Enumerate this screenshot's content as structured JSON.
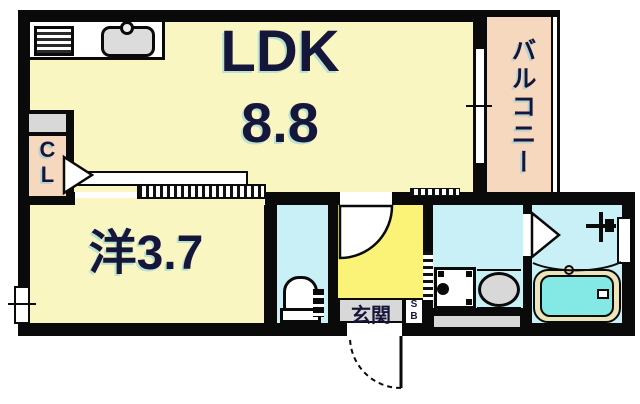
{
  "floorplan": {
    "rooms": {
      "ldk": {
        "name": "LDK",
        "size": "8.8"
      },
      "western_room": {
        "name": "洋3.7"
      },
      "balcony": {
        "name": "バルコニー"
      },
      "entrance": {
        "name": "玄関"
      },
      "closet": {
        "letters": [
          "C",
          "L"
        ]
      },
      "shoe_box": {
        "letters": [
          "S",
          "B"
        ]
      }
    },
    "fixtures": [
      "stove-icon",
      "kitchen-sink-icon",
      "closet-door-triangle",
      "ldk-balcony-window",
      "sliding-door",
      "toilet-icon",
      "entrance-door-arc",
      "room-door-arc",
      "washing-machine-icon",
      "washbasin-icon",
      "bathtub-icon",
      "shower-icon",
      "bathroom-door-triangle",
      "left-window",
      "bath-window"
    ],
    "colors": {
      "background": "#ffffff",
      "wall": "#0a0a0a",
      "room_yellow": "#faf6c2",
      "entrance_yellow": "#fbf378",
      "balcony_peach": "#f5d8bd",
      "water_cyan": "#c9f0f6",
      "bathtub_cyan": "#84e8e5",
      "bathtub_rim": "#ece4ba",
      "fixture_gray": "#d8d8d8",
      "label_ink": "#16163a"
    }
  }
}
